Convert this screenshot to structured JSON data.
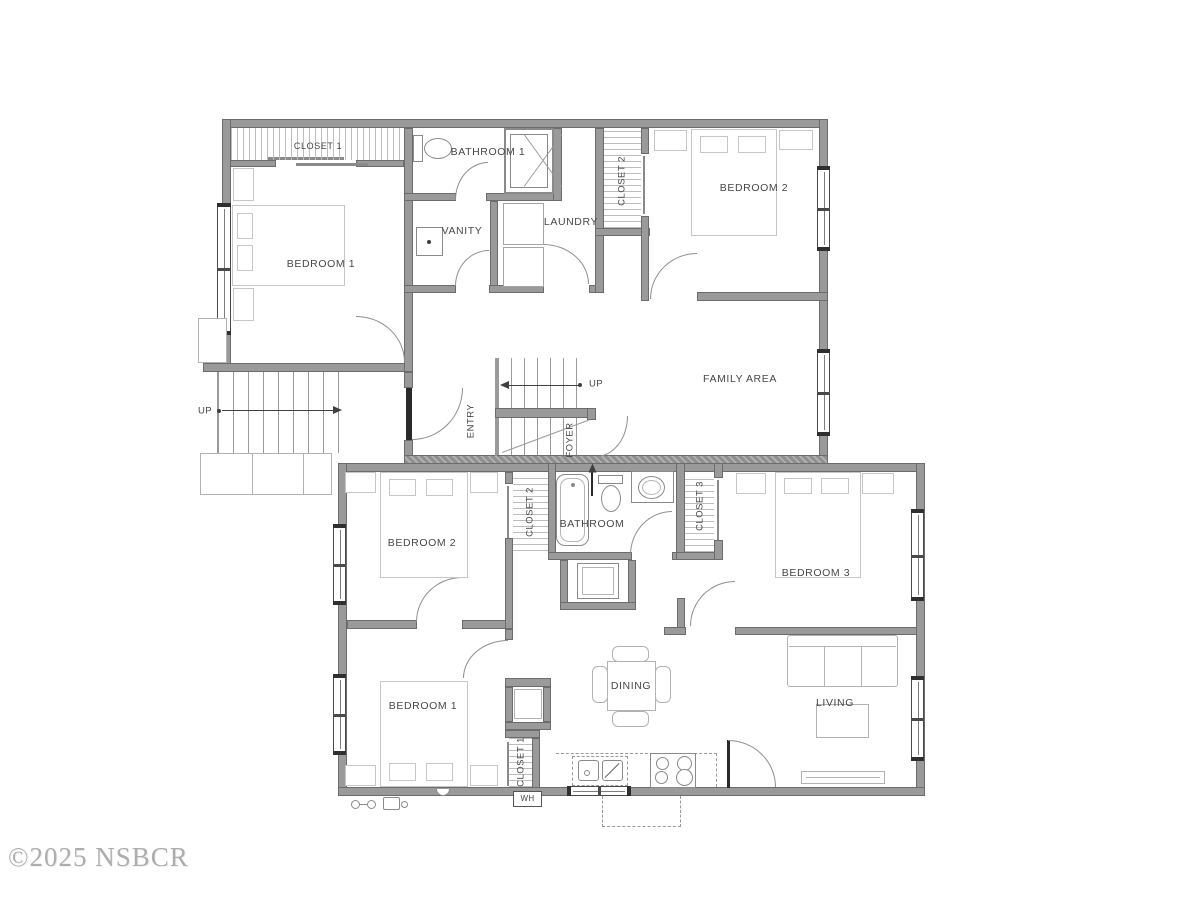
{
  "watermark": "©2025 NSBCR",
  "upper_floor": {
    "rooms": {
      "closet1": "CLOSET 1",
      "bathroom1": "BATHROOM 1",
      "closet2": "CLOSET 2",
      "bedroom2": "BEDROOM 2",
      "bedroom1": "BEDROOM 1",
      "vanity": "VANITY",
      "laundry": "LAUNDRY",
      "family_area": "FAMILY AREA",
      "entry": "ENTRY",
      "foyer": "FOYER"
    },
    "stairs": {
      "up_exterior": "UP",
      "up_foyer": "UP"
    }
  },
  "lower_floor": {
    "rooms": {
      "bedroom2": "BEDROOM 2",
      "closet2": "CLOSET 2",
      "bathroom": "BATHROOM",
      "closet3": "CLOSET 3",
      "bedroom3": "BEDROOM 3",
      "bedroom1": "BEDROOM 1",
      "closet1": "CLOSET 1",
      "dining": "DINING",
      "living": "LIVING"
    },
    "labels": {
      "water_heater": "WH"
    }
  },
  "colors": {
    "wall": "#9a9a9a",
    "wall_edge": "#6c6c6c",
    "label": "#474747",
    "furniture_line": "#c6c6c6",
    "fixture_line": "#8a8a8a",
    "watermark": "#adadad",
    "background": "#ffffff"
  }
}
